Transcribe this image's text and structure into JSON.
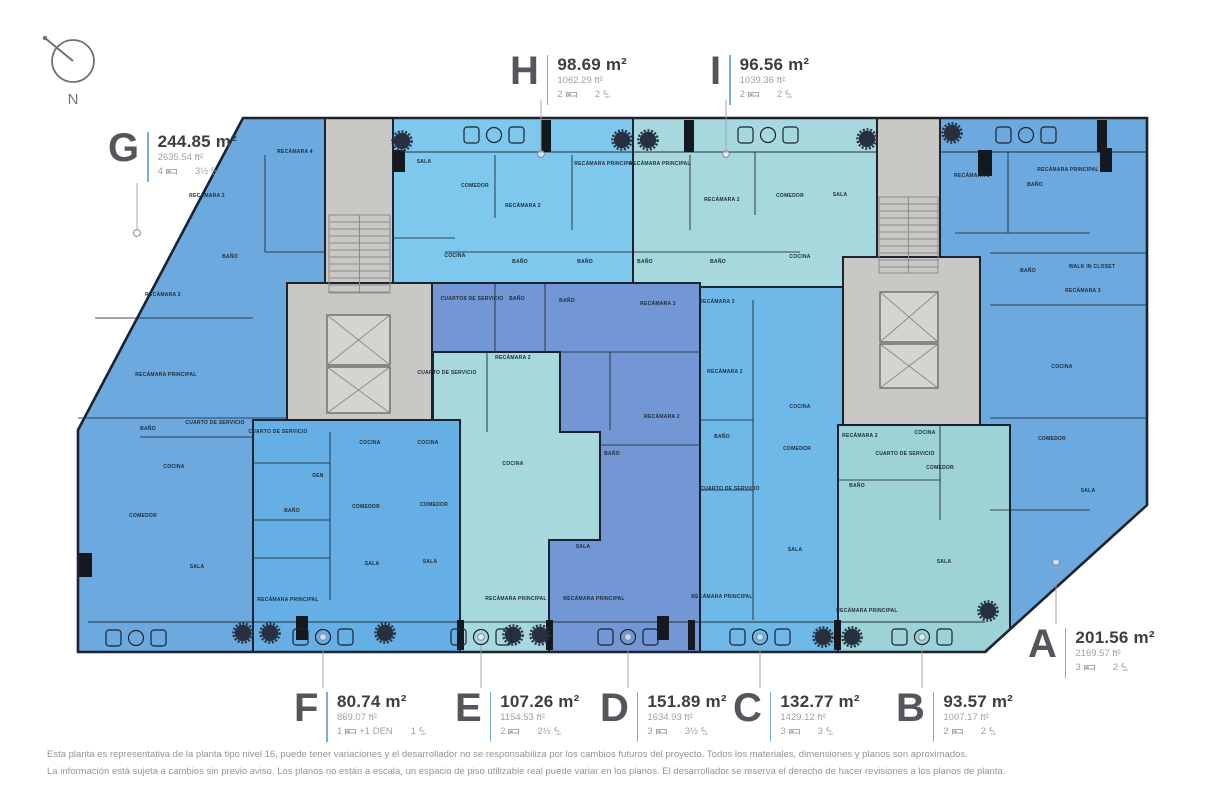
{
  "compass": {
    "label": "N"
  },
  "palette": {
    "wall": "#1b2330",
    "inner_wall": "#24303e",
    "core_fill": "#cac8c5",
    "core_detail": "#8e8c89",
    "leader": "#9aa0a5",
    "tree": "#26303e",
    "letter": "#53575c",
    "area": "#3a3f45",
    "muted": "#9ca1a6",
    "divider": "#79aece"
  },
  "units": [
    {
      "id": "G",
      "letter": "G",
      "area_m2": "244.85 m²",
      "area_ft2": "2635.54 ft²",
      "beds": "4",
      "extra": "",
      "baths": "3½",
      "color": "#6ca9df",
      "shape": "243,118 325,118 325,283 287,283 287,420 253,420 253,652 78,652 78,430",
      "callout": [
        108,
        132
      ],
      "leader": [
        137,
        183,
        137,
        229
      ],
      "dot": [
        137,
        233
      ],
      "rooms": [
        [
          "RECÁMARA 4",
          295,
          153
        ],
        [
          "RECÁMARA 3",
          207,
          197
        ],
        [
          "BAÑO",
          230,
          258
        ],
        [
          "RECÁMARA 2",
          163,
          296
        ],
        [
          "RECÁMARA PRINCIPAL",
          166,
          376
        ],
        [
          "BAÑO",
          148,
          430
        ],
        [
          "CUARTO DE SERVICIO",
          215,
          424
        ],
        [
          "COCINA",
          174,
          468
        ],
        [
          "COMEDOR",
          143,
          517
        ],
        [
          "SALA",
          197,
          568
        ]
      ]
    },
    {
      "id": "H",
      "letter": "H",
      "area_m2": "98.69 m²",
      "area_ft2": "1062.29 ft²",
      "beds": "2",
      "extra": "",
      "baths": "2",
      "color": "#7ec7ed",
      "shape": "392,118 633,118 633,287 392,287",
      "callout": [
        510,
        55
      ],
      "leader": [
        541,
        100,
        541,
        150
      ],
      "dot": [
        541,
        154
      ],
      "rooms": [
        [
          "SALA",
          424,
          163
        ],
        [
          "COMEDOR",
          475,
          187
        ],
        [
          "RECÁMARA 2",
          523,
          207
        ],
        [
          "RECÁMARA PRINCIPAL",
          605,
          165
        ],
        [
          "COCINA",
          455,
          257
        ],
        [
          "BAÑO",
          520,
          263
        ],
        [
          "BAÑO",
          585,
          263
        ]
      ]
    },
    {
      "id": "I",
      "letter": "I",
      "area_m2": "96.56 m²",
      "area_ft2": "1039.36 ft²",
      "beds": "2",
      "extra": "",
      "baths": "2",
      "color": "#a7d8de",
      "shape": "633,118 877,118 877,287 633,287",
      "callout": [
        710,
        55
      ],
      "leader": [
        726,
        100,
        726,
        150
      ],
      "dot": [
        726,
        154
      ],
      "rooms": [
        [
          "RECÁMARA PRINCIPAL",
          660,
          165
        ],
        [
          "RECÁMARA 2",
          722,
          201
        ],
        [
          "COMEDOR",
          790,
          197
        ],
        [
          "SALA",
          840,
          196
        ],
        [
          "BAÑO",
          645,
          263
        ],
        [
          "BAÑO",
          718,
          263
        ],
        [
          "COCINA",
          800,
          258
        ]
      ]
    },
    {
      "id": "D",
      "letter": "D",
      "area_m2": "151.89 m²",
      "area_ft2": "1634.93 ft²",
      "beds": "3",
      "extra": "",
      "baths": "3½",
      "color": "#7396d5",
      "shape": "432,283 700,283 700,652 432,652",
      "callout": [
        600,
        692
      ],
      "leader": [
        628,
        645,
        628,
        688
      ],
      "dot": [
        628,
        637
      ],
      "rooms": [
        [
          "CUARTOS DE SERVICIO",
          472,
          300
        ],
        [
          "BAÑO",
          517,
          300
        ],
        [
          "BAÑO",
          567,
          302
        ],
        [
          "RECÁMARA 3",
          658,
          305
        ],
        [
          "RECÁMARA 2",
          662,
          418
        ],
        [
          "BAÑO",
          612,
          455
        ],
        [
          "COCINA",
          513,
          465
        ],
        [
          "SALA",
          583,
          548
        ],
        [
          "RECÁMARA PRINCIPAL",
          594,
          600
        ]
      ]
    },
    {
      "id": "E",
      "letter": "E",
      "area_m2": "107.26 m²",
      "area_ft2": "1154.53 ft²",
      "beds": "2",
      "extra": "",
      "baths": "2½",
      "color": "#a7d8de",
      "shape": "433,352 560,352 560,432 600,432 600,540 549,540 549,652 460,652 460,432 433,432",
      "callout": [
        455,
        692
      ],
      "leader": [
        481,
        645,
        481,
        688
      ],
      "dot": [
        481,
        637
      ],
      "rooms": [
        [
          "CUARTO DE SERVICIO",
          447,
          374
        ],
        [
          "RECÁMARA 2",
          513,
          359
        ],
        [
          "COCINA",
          428,
          444
        ],
        [
          "COMEDOR",
          434,
          506
        ],
        [
          "SALA",
          430,
          563
        ],
        [
          "RECÁMARA PRINCIPAL",
          516,
          600
        ]
      ]
    },
    {
      "id": "C",
      "letter": "C",
      "area_m2": "132.77 m²",
      "area_ft2": "1429.12 ft²",
      "beds": "3",
      "extra": "",
      "baths": "3",
      "color": "#6fb9e8",
      "shape": "700,287 843,287 843,652 700,652",
      "callout": [
        733,
        692
      ],
      "leader": [
        760,
        645,
        760,
        688
      ],
      "dot": [
        760,
        637
      ],
      "rooms": [
        [
          "RECÁMARA 3",
          717,
          303
        ],
        [
          "RECÁMARA 2",
          725,
          373
        ],
        [
          "BAÑO",
          722,
          438
        ],
        [
          "CUARTO DE SERVICIO",
          730,
          490
        ],
        [
          "COCINA",
          800,
          408
        ],
        [
          "COMEDOR",
          797,
          450
        ],
        [
          "SALA",
          795,
          551
        ],
        [
          "RECÁMARA PRINCIPAL",
          722,
          598
        ]
      ]
    },
    {
      "id": "B",
      "letter": "B",
      "area_m2": "93.57 m²",
      "area_ft2": "1007.17 ft²",
      "beds": "2",
      "extra": "",
      "baths": "2",
      "color": "#9dd2d7",
      "shape": "838,425 1010,425 1010,652 838,652",
      "callout": [
        896,
        692
      ],
      "leader": [
        922,
        645,
        922,
        688
      ],
      "dot": [
        922,
        637
      ],
      "rooms": [
        [
          "RECÁMARA 2",
          860,
          437
        ],
        [
          "COCINA",
          925,
          434
        ],
        [
          "CUARTO DE SERVICIO",
          905,
          455
        ],
        [
          "COMEDOR",
          940,
          469
        ],
        [
          "BAÑO",
          857,
          487
        ],
        [
          "SALA",
          944,
          563
        ],
        [
          "RECÁMARA PRINCIPAL",
          867,
          612
        ]
      ]
    },
    {
      "id": "A",
      "letter": "A",
      "area_m2": "201.56 m²",
      "area_ft2": "2169.57 ft²",
      "beds": "3",
      "extra": "",
      "baths": "2",
      "color": "#6ca9df",
      "shape": "940,118 1147,118 1147,652 1010,652 1010,425 980,425 980,257 940,257",
      "callout": [
        1028,
        628
      ],
      "leader": [
        1056,
        566,
        1056,
        624
      ],
      "dot": [
        1056,
        562
      ],
      "rooms": [
        [
          "RECÁMARA 2",
          972,
          177
        ],
        [
          "BAÑO",
          1035,
          186
        ],
        [
          "RECÁMARA PRINCIPAL",
          1068,
          171
        ],
        [
          "BAÑO",
          1028,
          272
        ],
        [
          "WALK IN CLOSET",
          1092,
          268
        ],
        [
          "RECÁMARA 3",
          1083,
          292
        ],
        [
          "COCINA",
          1062,
          368
        ],
        [
          "COMEDOR",
          1052,
          440
        ],
        [
          "SALA",
          1088,
          492
        ]
      ]
    },
    {
      "id": "F",
      "letter": "F",
      "area_m2": "80.74 m²",
      "area_ft2": "869.07 ft²",
      "beds": "1",
      "extra": "+1 DEN",
      "baths": "1",
      "color": "#66afe4",
      "shape": "253,420 460,420 460,652 253,652",
      "callout": [
        294,
        692
      ],
      "leader": [
        323,
        645,
        323,
        688
      ],
      "dot": [
        323,
        637
      ],
      "rooms": [
        [
          "CUARTO DE SERVICIO",
          278,
          433
        ],
        [
          "DEN",
          318,
          477
        ],
        [
          "BAÑO",
          292,
          512
        ],
        [
          "RECÁMARA PRINCIPAL",
          288,
          601
        ],
        [
          "COCINA",
          370,
          444
        ],
        [
          "COMEDOR",
          366,
          508
        ],
        [
          "SALA",
          372,
          565
        ]
      ]
    }
  ],
  "plan": {
    "outline": "243,118 1147,118 1147,505 985,652 78,652 78,430",
    "clip": "983,656 1150,500 1150,656",
    "cores": [
      [
        325,
        118,
        68,
        165
      ],
      [
        287,
        283,
        145,
        137
      ],
      [
        877,
        118,
        63,
        139
      ],
      [
        843,
        257,
        137,
        168
      ]
    ],
    "stairs": [
      [
        329,
        215,
        61,
        78
      ],
      [
        879,
        197,
        59,
        76
      ]
    ],
    "elevators": [
      [
        327,
        315,
        63,
        50
      ],
      [
        327,
        367,
        63,
        46
      ],
      [
        880,
        292,
        58,
        50
      ],
      [
        880,
        344,
        58,
        44
      ]
    ],
    "walls": [
      [
        95,
        318,
        253,
        318
      ],
      [
        78,
        418,
        287,
        418
      ],
      [
        140,
        437,
        253,
        437
      ],
      [
        265,
        252,
        325,
        252
      ],
      [
        265,
        155,
        265,
        252
      ],
      [
        495,
        155,
        495,
        218
      ],
      [
        392,
        238,
        455,
        238
      ],
      [
        572,
        155,
        572,
        230
      ],
      [
        445,
        252,
        633,
        252
      ],
      [
        690,
        155,
        690,
        230
      ],
      [
        633,
        252,
        800,
        252
      ],
      [
        755,
        152,
        755,
        215
      ],
      [
        955,
        233,
        1090,
        233
      ],
      [
        990,
        253,
        1147,
        253
      ],
      [
        990,
        305,
        1147,
        305
      ],
      [
        1008,
        152,
        1008,
        233
      ],
      [
        990,
        418,
        1147,
        418
      ],
      [
        990,
        510,
        1090,
        510
      ],
      [
        330,
        432,
        330,
        600
      ],
      [
        253,
        463,
        330,
        463
      ],
      [
        253,
        520,
        330,
        520
      ],
      [
        253,
        558,
        330,
        558
      ],
      [
        487,
        352,
        487,
        432
      ],
      [
        495,
        283,
        495,
        352
      ],
      [
        545,
        283,
        545,
        352
      ],
      [
        560,
        352,
        700,
        352
      ],
      [
        610,
        352,
        610,
        430
      ],
      [
        600,
        445,
        700,
        445
      ],
      [
        753,
        300,
        753,
        620
      ],
      [
        700,
        420,
        753,
        420
      ],
      [
        700,
        490,
        753,
        490
      ],
      [
        838,
        480,
        940,
        480
      ],
      [
        940,
        425,
        940,
        520
      ]
    ],
    "balcony_lines": [
      [
        88,
        622,
        985,
        622
      ],
      [
        392,
        152,
        877,
        152
      ],
      [
        940,
        152,
        1147,
        152
      ]
    ],
    "balcony_dividers": [
      [
        457,
        620,
        7,
        30
      ],
      [
        546,
        620,
        7,
        30
      ],
      [
        688,
        620,
        7,
        30
      ],
      [
        834,
        620,
        7,
        30
      ],
      [
        541,
        120,
        10,
        32
      ],
      [
        684,
        120,
        10,
        32
      ],
      [
        1097,
        120,
        10,
        32
      ]
    ],
    "columns": [
      [
        296,
        616,
        12,
        24
      ],
      [
        657,
        616,
        12,
        24
      ],
      [
        78,
        553,
        14,
        24
      ],
      [
        978,
        150,
        14,
        26
      ],
      [
        1100,
        148,
        12,
        24
      ],
      [
        393,
        150,
        12,
        22
      ]
    ],
    "trees": [
      [
        402,
        141
      ],
      [
        622,
        140
      ],
      [
        648,
        140
      ],
      [
        867,
        139
      ],
      [
        952,
        133
      ],
      [
        243,
        633
      ],
      [
        270,
        633
      ],
      [
        385,
        633
      ],
      [
        513,
        635
      ],
      [
        540,
        635
      ],
      [
        823,
        637
      ],
      [
        852,
        637
      ],
      [
        988,
        611
      ]
    ],
    "chair_groups": [
      [
        494,
        135
      ],
      [
        768,
        135
      ],
      [
        1026,
        135
      ],
      [
        136,
        638
      ],
      [
        323,
        637
      ],
      [
        481,
        637
      ],
      [
        628,
        637
      ],
      [
        760,
        637
      ],
      [
        922,
        637
      ]
    ]
  },
  "footer": {
    "line1": "Esta planta es representativa de la planta tipo nivel 16, puede tener variaciones y el desarrollador no se responsabiliza por los cambios futuros del proyecto. Todos los materiales, dimensiones y planos son aproximados.",
    "line2": "La información está sujeta a cambios sin previo aviso. Los planos no están a escala, un espacio de piso utilizable real puede variar en los planos. El desarrollador se reserva el derecho de hacer revisiones a los planos de planta."
  }
}
